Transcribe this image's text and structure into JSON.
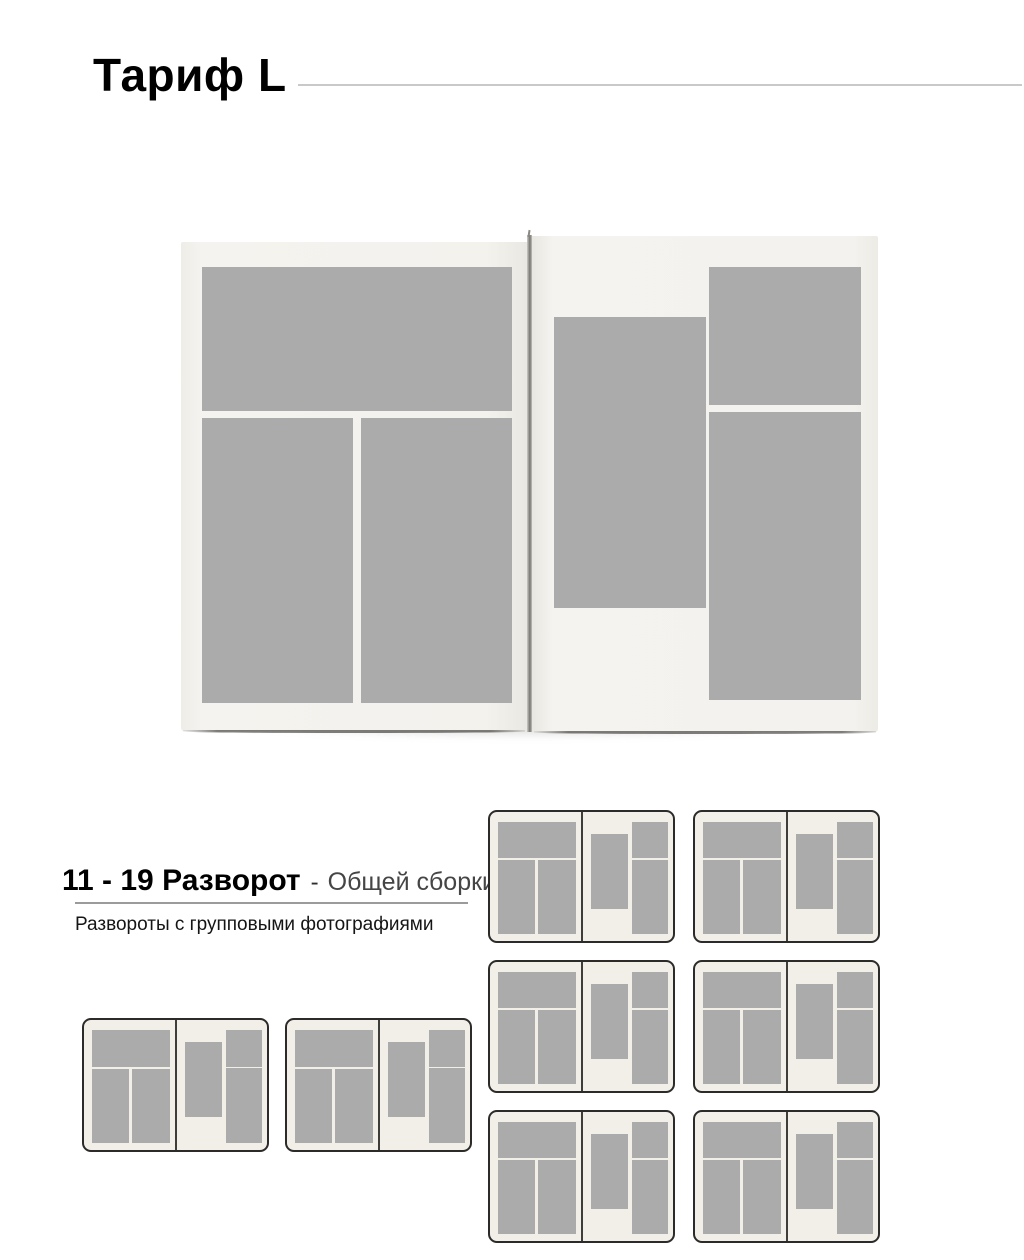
{
  "title": "Тариф L",
  "section": {
    "range": "11 - 19 Разворот",
    "separator": "-",
    "subtitle": "Общей сборки",
    "description": "Развороты с групповыми фотографиями"
  },
  "book_preview": {
    "left_page_photos": [
      "top-wide",
      "bottom-left-tall",
      "bottom-right-tall"
    ],
    "right_page_photos": [
      "center-left-tall",
      "top-right",
      "bottom-right-tall"
    ]
  },
  "thumbnails": {
    "left_row": {
      "count": 2
    },
    "right_grid": {
      "count": 6,
      "columns": 2,
      "rows": 3
    }
  },
  "colors": {
    "photo_placeholder": "#ababab",
    "book_page": "#f3f1ec",
    "card_bg": "#f2efe9",
    "card_border": "#2d2b29",
    "card_spine": "#3f3d3a",
    "title_rule": "#c9c9c9",
    "section_rule": "#9b9b9b"
  }
}
